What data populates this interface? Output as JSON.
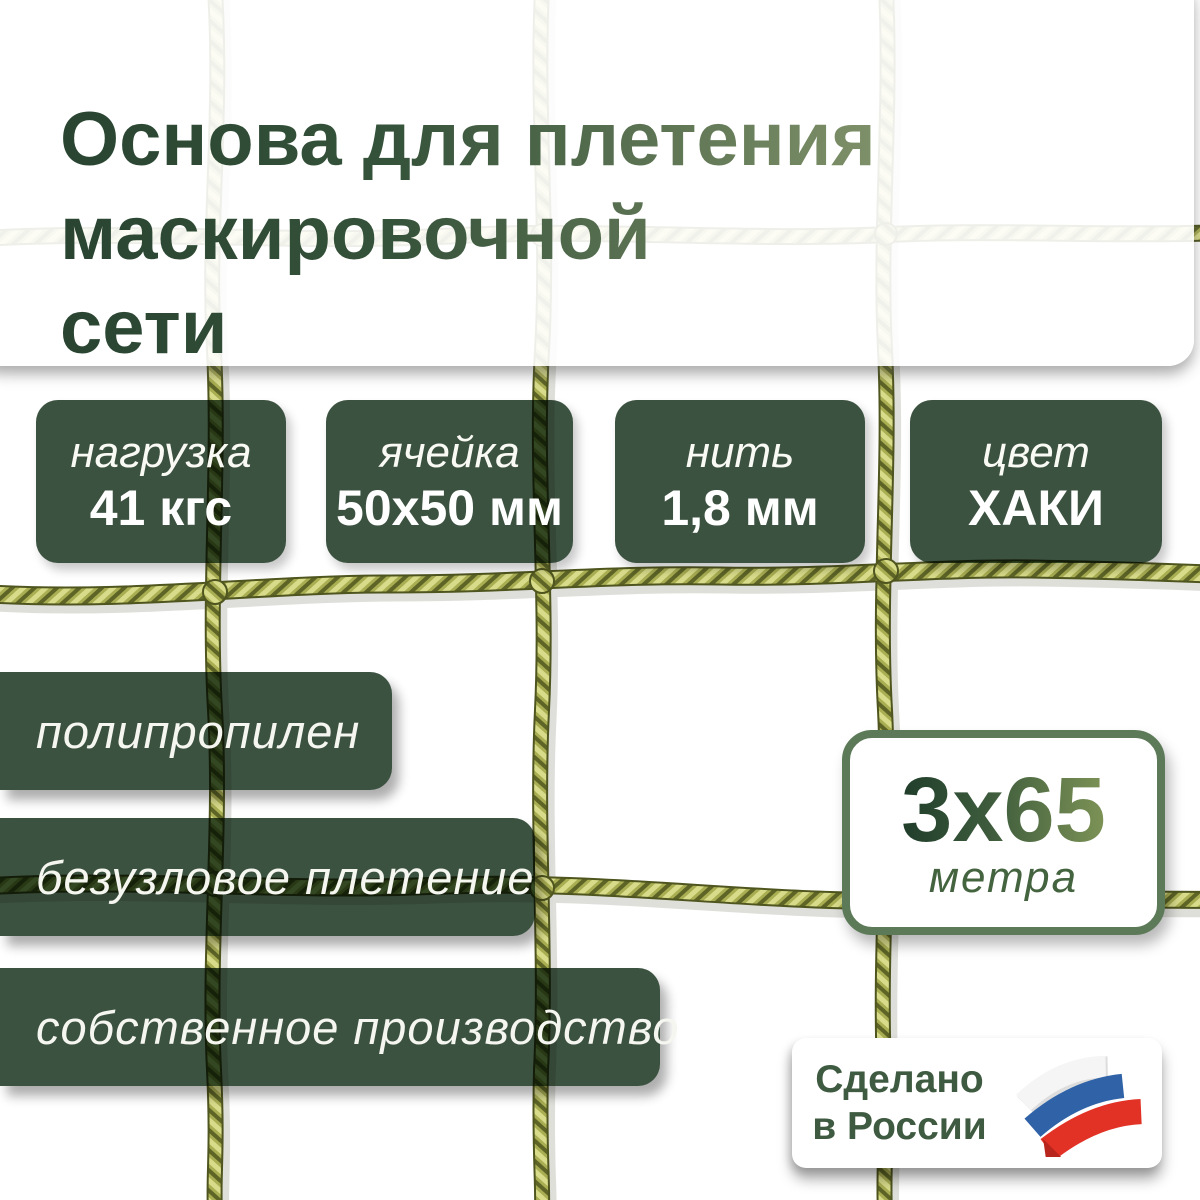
{
  "product_card": {
    "title_lines": [
      "Основа для плетения",
      "маскировочной",
      "сети"
    ],
    "specs": [
      {
        "label": "нагрузка",
        "value": "41 кгс"
      },
      {
        "label": "ячейка",
        "value": "50x50 мм"
      },
      {
        "label": "нить",
        "value": "1,8 мм"
      },
      {
        "label": "цвет",
        "value": "ХАКИ"
      }
    ],
    "features": [
      "полипропилен",
      "безузловое плетение",
      "собственное производство"
    ],
    "dimensions": {
      "size": "3x65",
      "unit": "метра"
    },
    "made_in": {
      "line1": "Сделано",
      "line2": "в России",
      "icon": "russian-flag-icon"
    },
    "colors": {
      "badge_green": "#3c5240",
      "title_dark": "#294431",
      "title_light": "#80926a",
      "net_khaki": "#a9ae52",
      "size_card_border": "#5c7a58",
      "flag_blue": "#2f62a7",
      "flag_red": "#e23226"
    }
  }
}
